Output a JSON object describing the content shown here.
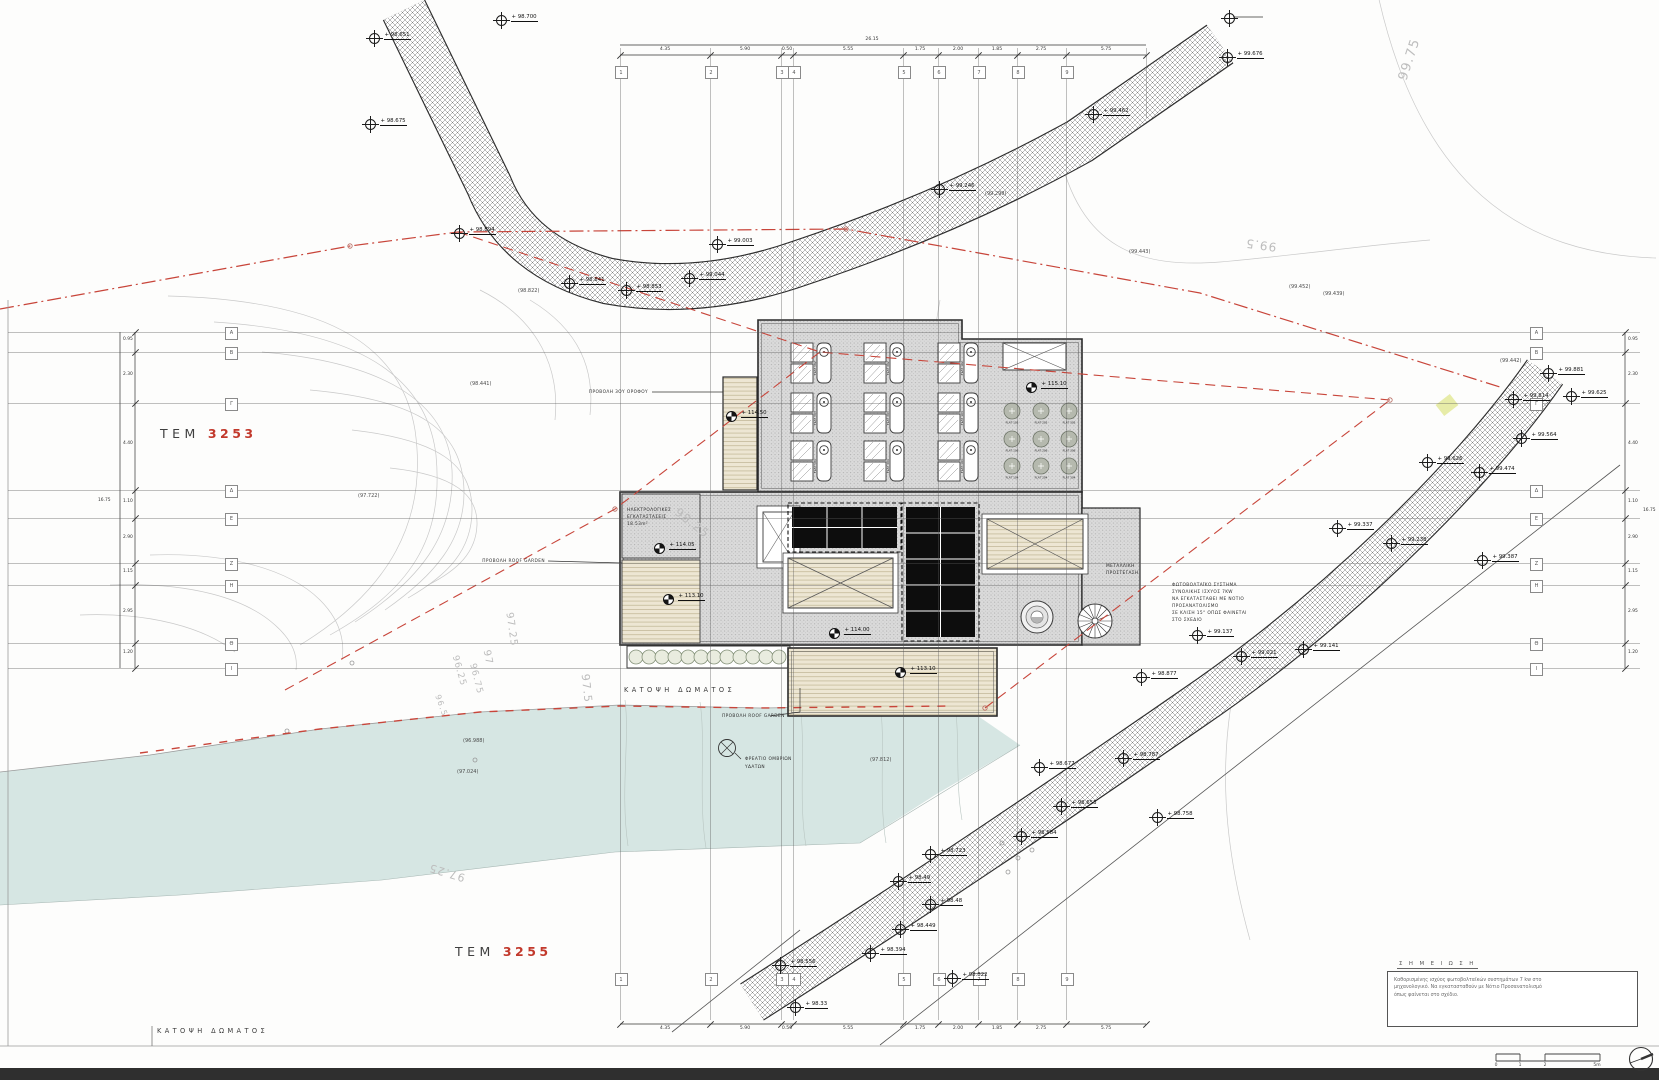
{
  "note_box": {
    "title": "Σ Η Μ Ε Ι Ω Σ Η",
    "lines": [
      "Καθορισμένης ισχύος φωτοβολταϊκών συστημάτων 7 kw στο",
      "μηχανολογικό. Να εγκατασταθούν με Νότιο Προσανατολισμό",
      "όπως φαίνεται στο σχέδιο."
    ]
  },
  "parcels": [
    {
      "prefix": "ΤΕΜ",
      "number": "3253",
      "x": 160,
      "y": 426
    },
    {
      "prefix": "ΤΕΜ",
      "number": "3255",
      "x": 455,
      "y": 944
    }
  ],
  "titles": [
    {
      "text": "ΚΑΤΟΨΗ ΔΩΜΑΤΟΣ",
      "x": 624,
      "y": 686
    },
    {
      "text": "ΚΑΤΟΨΗ ΔΩΜΑΤΟΣ",
      "x": 157,
      "y": 1027
    }
  ],
  "pv_annotation": {
    "x": 1172,
    "y": 583,
    "lines": [
      "ΦΩΤΟΒΟΛΤΑΪΚΟ ΣΥΣΤΗΜΑ",
      "ΣΥΝΟΛΙΚΗΣ ΙΣΧΥΟΣ 7KW",
      "ΝΑ ΕΓΚΑΤΑΣΤΑΘΕΙ ΜΕ ΝΟΤΙΟ",
      "ΠΡΟΣΑΝΑΤΟΛΙΣΜΟ",
      "ΣΕ ΚΛΙΣΗ 15° ΟΠΩΣ ΦΑΙΝΕΤΑΙ",
      "ΣΤΟ ΣΧΕΔΙΟ"
    ]
  },
  "annotations": [
    {
      "text": "ΠΡΟΒΟΛΗ 3ΟΥ ΟΡΟΦΟΥ",
      "x": 648,
      "y": 390,
      "align": "r"
    },
    {
      "text": "ΠΡΟΒΟΛΗ ROOF GARDEN",
      "x": 545,
      "y": 559,
      "align": "r"
    },
    {
      "text": "ΠΡΟΒΟΛΗ ROOF GARDEN",
      "x": 722,
      "y": 714
    },
    {
      "text": "ΦΡΕΑΤΙΟ ΟΜΒΡΙΩΝ",
      "x": 745,
      "y": 757
    },
    {
      "text": "ΥΔΑΤΩΝ",
      "x": 745,
      "y": 765
    },
    {
      "text": "ΗΛΕΚΤΡΟΛΟΓΙΚΕΣ",
      "x": 627,
      "y": 508
    },
    {
      "text": "ΕΓΚΑΤΑΣΤΑΣΕΙΣ",
      "x": 627,
      "y": 515
    },
    {
      "text": "18.53m²",
      "x": 627,
      "y": 522
    },
    {
      "text": "ΜΕΤΑΛΛΙΚΗ",
      "x": 1106,
      "y": 564
    },
    {
      "text": "ΠΡΟΣΤΕΓΑΣΗ",
      "x": 1106,
      "y": 571
    }
  ],
  "contour_labels": [
    {
      "t": "99.75",
      "x": 1388,
      "y": 52,
      "r": -72,
      "s": 13
    },
    {
      "t": "99.5",
      "x": 1245,
      "y": 238,
      "r": 188,
      "s": 12
    },
    {
      "t": "98.25",
      "x": 672,
      "y": 516,
      "r": 38,
      "s": 12
    },
    {
      "t": "97.25",
      "x": 494,
      "y": 624,
      "r": 82,
      "s": 10
    },
    {
      "t": "97",
      "x": 480,
      "y": 652,
      "r": 79,
      "s": 10
    },
    {
      "t": "96.75",
      "x": 460,
      "y": 674,
      "r": 76,
      "s": 9
    },
    {
      "t": "96.25",
      "x": 443,
      "y": 666,
      "r": 74,
      "s": 9
    },
    {
      "t": "96.5",
      "x": 430,
      "y": 701,
      "r": 70,
      "s": 8
    },
    {
      "t": "97.5",
      "x": 572,
      "y": 682,
      "r": 84,
      "s": 11
    },
    {
      "t": "97.25",
      "x": 428,
      "y": 866,
      "r": 197,
      "s": 11
    }
  ],
  "ground_elevations": [
    {
      "t": "(98.441)",
      "x": 470,
      "y": 381
    },
    {
      "t": "(97.722)",
      "x": 358,
      "y": 493
    },
    {
      "t": "(96.988)",
      "x": 463,
      "y": 738
    },
    {
      "t": "(97.024)",
      "x": 457,
      "y": 769
    },
    {
      "t": "(97.812)",
      "x": 870,
      "y": 757
    },
    {
      "t": "(98.822)",
      "x": 518,
      "y": 288
    },
    {
      "t": "(99.299)",
      "x": 985,
      "y": 191
    },
    {
      "t": "(99.443)",
      "x": 1129,
      "y": 249
    },
    {
      "t": "(99.452)",
      "x": 1289,
      "y": 284
    },
    {
      "t": "(99.439)",
      "x": 1323,
      "y": 291
    },
    {
      "t": "(99.442)",
      "x": 1500,
      "y": 358
    }
  ],
  "spot_elevations": [
    {
      "x": 500,
      "y": 19,
      "t": "+ 98.700"
    },
    {
      "x": 373,
      "y": 37,
      "t": "+ 98.651"
    },
    {
      "x": 369,
      "y": 123,
      "t": "+ 98.675"
    },
    {
      "x": 458,
      "y": 232,
      "t": "+ 98.894"
    },
    {
      "x": 568,
      "y": 282,
      "t": "+ 98.841"
    },
    {
      "x": 625,
      "y": 289,
      "t": "+ 98.853"
    },
    {
      "x": 688,
      "y": 277,
      "t": "+ 99.044"
    },
    {
      "x": 716,
      "y": 243,
      "t": "+ 99.003"
    },
    {
      "x": 938,
      "y": 188,
      "t": "+ 99.246"
    },
    {
      "x": 1092,
      "y": 113,
      "t": "+ 99.462"
    },
    {
      "x": 1226,
      "y": 56,
      "t": "+ 99.676"
    },
    {
      "x": 1228,
      "y": 17,
      "t": ""
    },
    {
      "x": 1547,
      "y": 372,
      "t": "+ 99.881"
    },
    {
      "x": 1512,
      "y": 398,
      "t": "+ 99.814"
    },
    {
      "x": 1570,
      "y": 395,
      "t": "+ 99.625"
    },
    {
      "x": 1520,
      "y": 437,
      "t": "+ 99.564"
    },
    {
      "x": 1426,
      "y": 461,
      "t": "+ 99.626"
    },
    {
      "x": 1478,
      "y": 471,
      "t": "+ 99.474"
    },
    {
      "x": 1336,
      "y": 527,
      "t": "+ 99.337"
    },
    {
      "x": 1390,
      "y": 542,
      "t": "+ 99.238"
    },
    {
      "x": 1481,
      "y": 559,
      "t": "+ 99.387"
    },
    {
      "x": 1196,
      "y": 634,
      "t": "+ 99.137"
    },
    {
      "x": 1240,
      "y": 655,
      "t": "+ 99.021"
    },
    {
      "x": 1302,
      "y": 648,
      "t": "+ 99.141"
    },
    {
      "x": 1140,
      "y": 676,
      "t": "+ 98.877"
    },
    {
      "x": 1122,
      "y": 757,
      "t": "+ 98.787"
    },
    {
      "x": 1038,
      "y": 766,
      "t": "+ 98.677"
    },
    {
      "x": 1060,
      "y": 805,
      "t": "+ 98.653"
    },
    {
      "x": 1020,
      "y": 835,
      "t": "+ 98.584"
    },
    {
      "x": 1156,
      "y": 816,
      "t": "+ 98.758"
    },
    {
      "x": 929,
      "y": 853,
      "t": "+ 98.723"
    },
    {
      "x": 897,
      "y": 880,
      "t": "+ 98.49"
    },
    {
      "x": 929,
      "y": 903,
      "t": "+ 98.48"
    },
    {
      "x": 899,
      "y": 928,
      "t": "+ 98.449"
    },
    {
      "x": 869,
      "y": 952,
      "t": "+ 98.394"
    },
    {
      "x": 779,
      "y": 964,
      "t": "+ 98.556"
    },
    {
      "x": 951,
      "y": 977,
      "t": "+ 98.822"
    },
    {
      "x": 794,
      "y": 1006,
      "t": "+ 98.33"
    }
  ],
  "benchmarks": [
    {
      "x": 658,
      "y": 547,
      "t": "+ 114.05"
    },
    {
      "x": 667,
      "y": 598,
      "t": "+ 113.10"
    },
    {
      "x": 833,
      "y": 632,
      "t": "+ 114.00"
    },
    {
      "x": 899,
      "y": 671,
      "t": "+ 113.10"
    },
    {
      "x": 1030,
      "y": 386,
      "t": "+ 115.10"
    },
    {
      "x": 730,
      "y": 415,
      "t": "+ 114.50"
    }
  ],
  "grid": {
    "columns": [
      {
        "n": "1",
        "x": 620
      },
      {
        "n": "2",
        "x": 710
      },
      {
        "n": "3",
        "x": 781
      },
      {
        "n": "4",
        "x": 793
      },
      {
        "n": "5",
        "x": 903
      },
      {
        "n": "6",
        "x": 938
      },
      {
        "n": "7",
        "x": 978
      },
      {
        "n": "8",
        "x": 1017
      },
      {
        "n": "9",
        "x": 1066
      },
      {
        "n": "",
        "x": 1146
      }
    ],
    "rows": [
      {
        "n": "Α",
        "y": 332
      },
      {
        "n": "Β",
        "y": 352
      },
      {
        "n": "Γ",
        "y": 403
      },
      {
        "n": "Δ",
        "y": 490
      },
      {
        "n": "Ε",
        "y": 518
      },
      {
        "n": "Ζ",
        "y": 563
      },
      {
        "n": "Η",
        "y": 585
      },
      {
        "n": "Θ",
        "y": 643
      },
      {
        "n": "Ι",
        "y": 668
      }
    ]
  },
  "dimensions": {
    "top": [
      {
        "t": "4.35",
        "x": 665
      },
      {
        "t": "5.90",
        "x": 745
      },
      {
        "t": "0.50",
        "x": 787
      },
      {
        "t": "5.55",
        "x": 848
      },
      {
        "t": "1.75",
        "x": 920
      },
      {
        "t": "2.00",
        "x": 958
      },
      {
        "t": "1.85",
        "x": 997
      },
      {
        "t": "2.75",
        "x": 1041
      },
      {
        "t": "5.75",
        "x": 1106
      }
    ],
    "top_total": {
      "t": "26.15",
      "x": 872
    },
    "left": [
      {
        "t": "0.95",
        "y": 339
      },
      {
        "t": "2.30",
        "y": 374
      },
      {
        "t": "4.40",
        "y": 443
      },
      {
        "t": "1.10",
        "y": 501
      },
      {
        "t": "2.90",
        "y": 537
      },
      {
        "t": "1.15",
        "y": 571
      },
      {
        "t": "2.95",
        "y": 611
      },
      {
        "t": "1.20",
        "y": 652
      }
    ],
    "left_total": {
      "t": "16.75",
      "x": 98,
      "y": 498
    },
    "right_total": {
      "t": "16.75",
      "x": 1643,
      "y": 508
    }
  },
  "building": {
    "skylight_flats": [
      "FLAT 502",
      "FLAT 302",
      "FLAT 102",
      "FLAT 503",
      "FLAT 303",
      "FLAT 103",
      "FLAT 504",
      "FLAT 304",
      "FLAT 104"
    ],
    "circle_flats": [
      "FLAT 105",
      "FLAT 205",
      "FLAT 305",
      "FLAT 106",
      "FLAT 206",
      "FLAT 306",
      "FLAT 104",
      "FLAT 204",
      "FLAT 304"
    ]
  },
  "scale_bar": {
    "ticks": [
      {
        "t": "0",
        "x": 1496
      },
      {
        "t": "1",
        "x": 1520
      },
      {
        "t": "2",
        "x": 1545
      },
      {
        "t": "5m",
        "x": 1597
      }
    ]
  },
  "colors": {
    "water": "#d3e4e1",
    "boundary_red": "#c8453a",
    "parcel_red": "#c2392c"
  }
}
